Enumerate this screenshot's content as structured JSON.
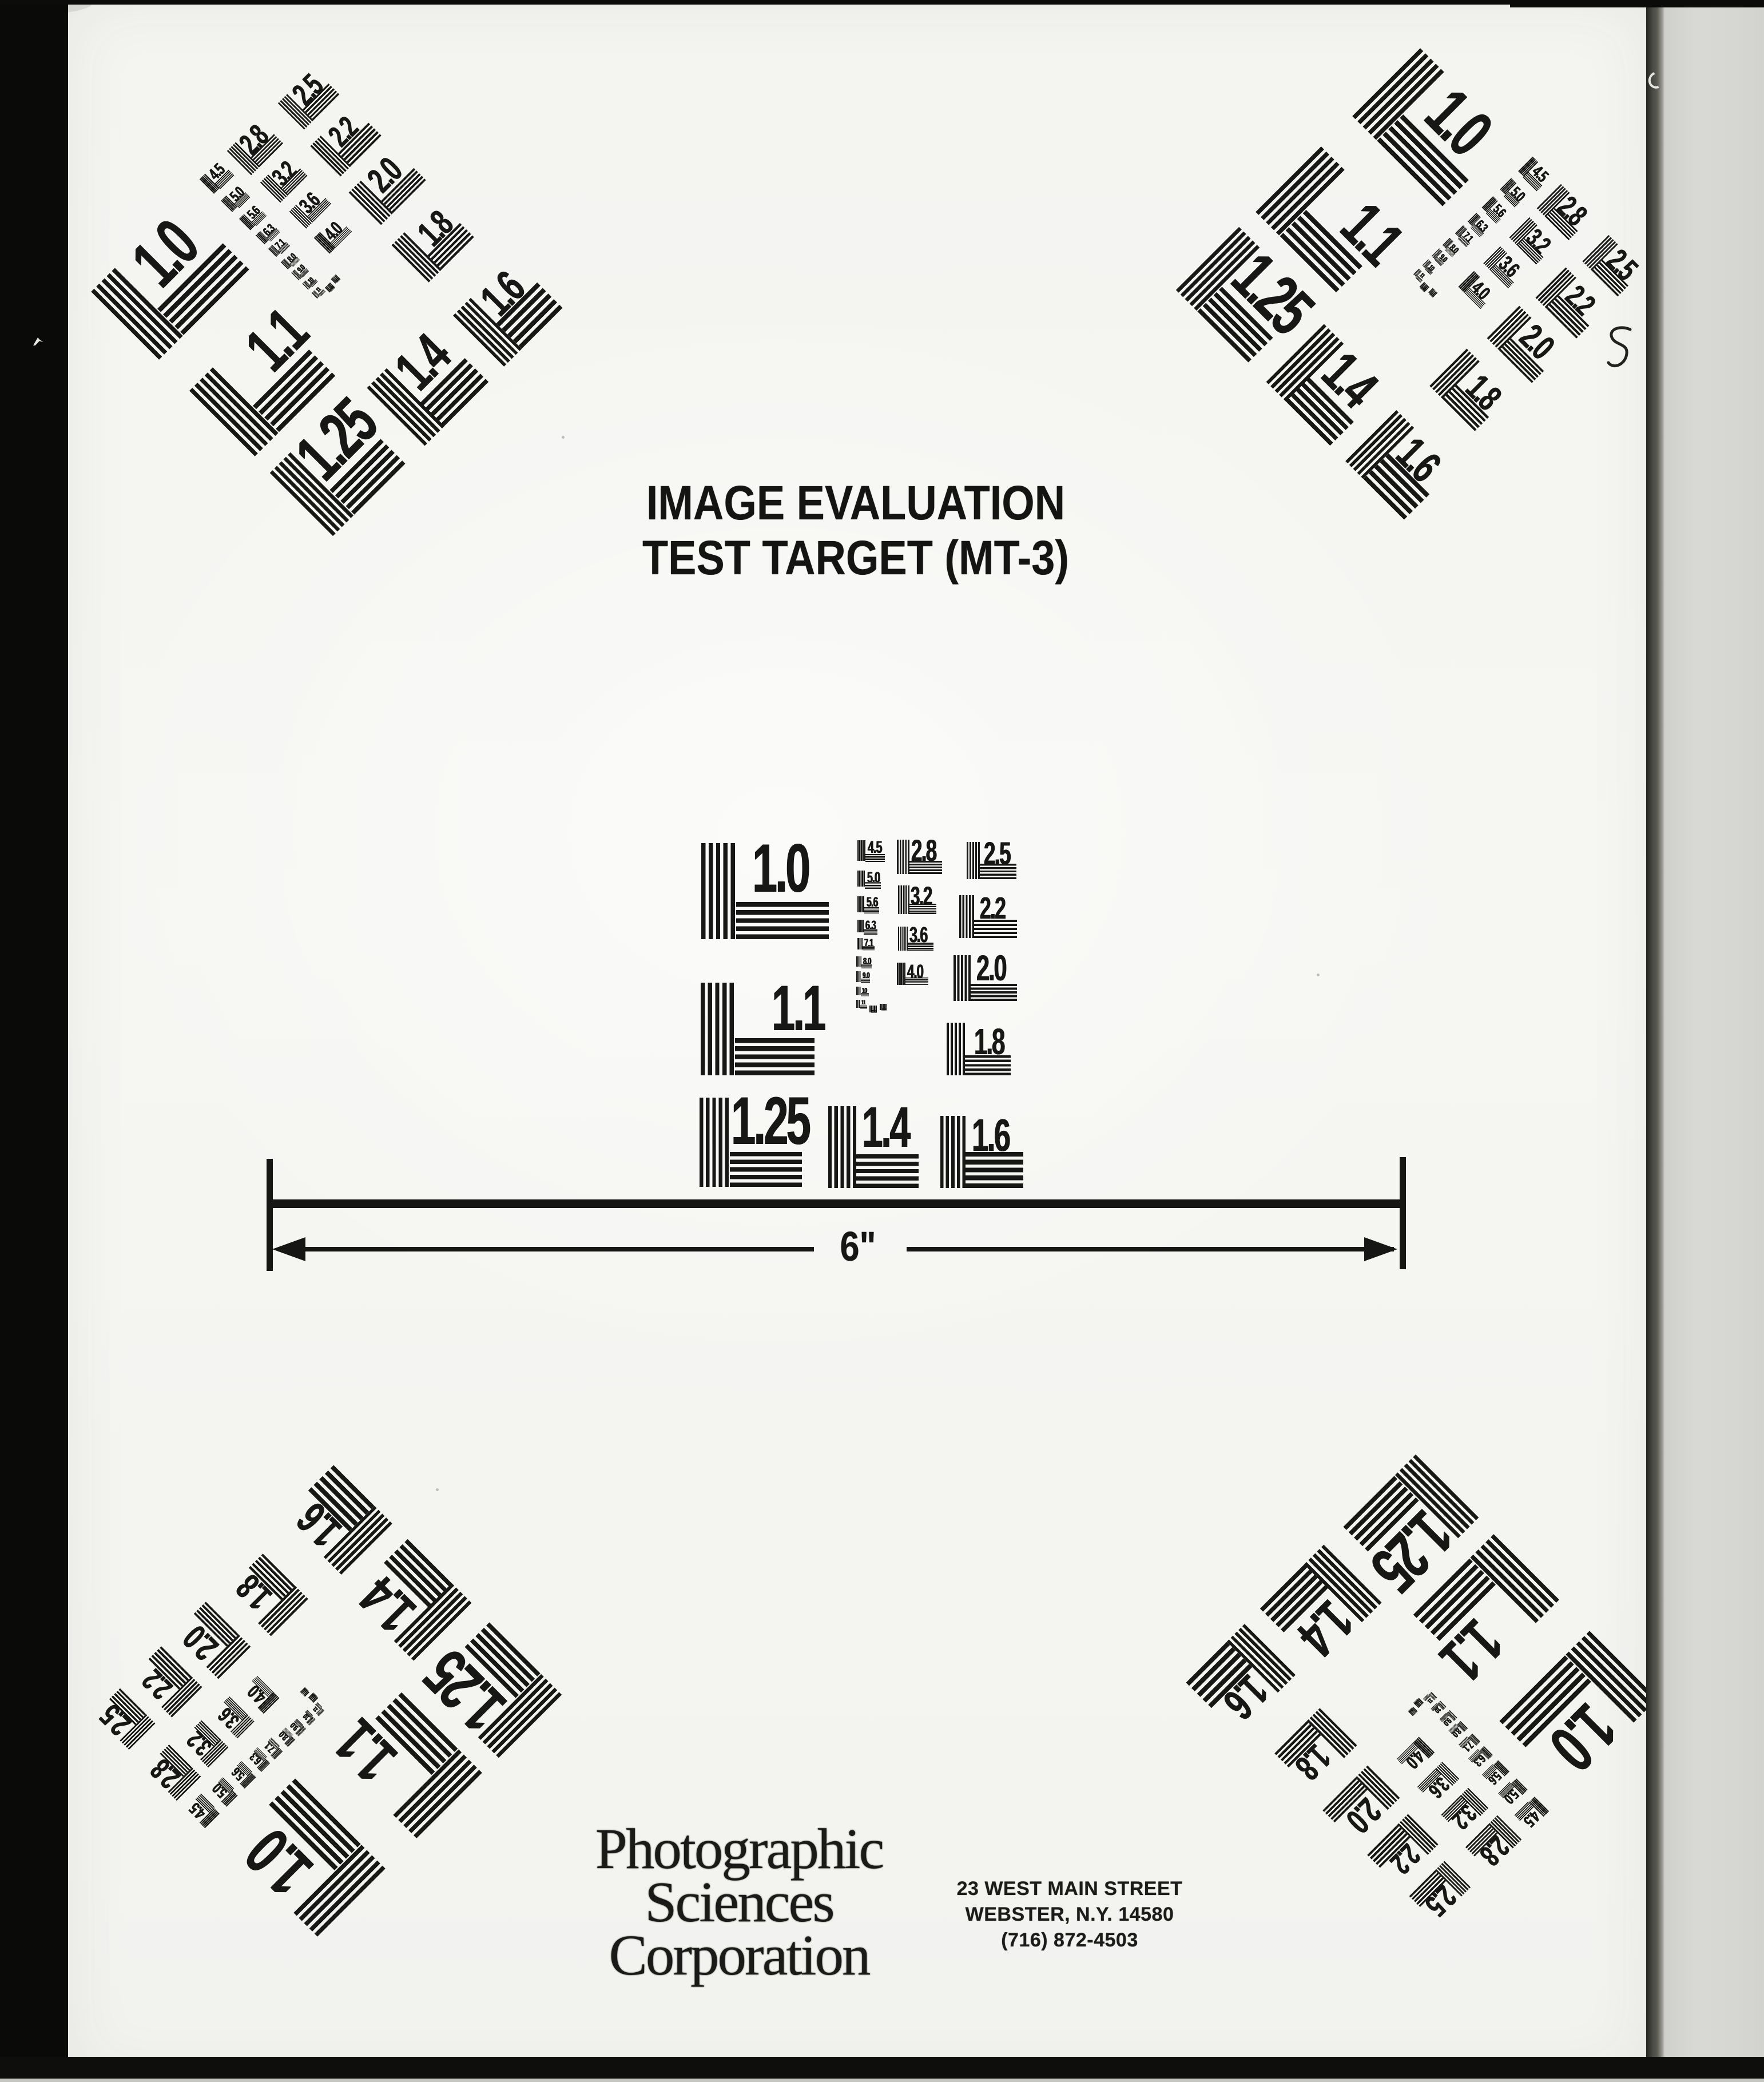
{
  "document": {
    "title_line1": "IMAGE EVALUATION",
    "title_line2": "TEST TARGET (MT-3)",
    "ruler_label": "6\"",
    "footer": {
      "company_line1": "Photographic",
      "company_line2": "Sciences",
      "company_line3": "Corporation",
      "address_line1": "23 WEST MAIN STREET",
      "address_line2": "WEBSTER, N.Y. 14580",
      "address_line3": "(716) 872-4503"
    }
  },
  "test_pattern": {
    "name": "MT-3 resolution test pattern",
    "element_labels": [
      "1.0",
      "1.1",
      "1.25",
      "1.4",
      "1.6",
      "1.8",
      "2.0",
      "2.2",
      "2.5",
      "2.8",
      "3.2",
      "3.6",
      "4.0",
      "4.5",
      "5.0",
      "5.6",
      "6.3",
      "7.1",
      "8.0",
      "9.0",
      "10",
      "11",
      "",
      ""
    ]
  },
  "colors": {
    "ink": "#171715",
    "paper": "#f5f5f2",
    "scan_edge_black": "#0a0a09",
    "page_shadow_band": "#4a4a44",
    "adjacent_page_gray": "#d6d6d2"
  }
}
